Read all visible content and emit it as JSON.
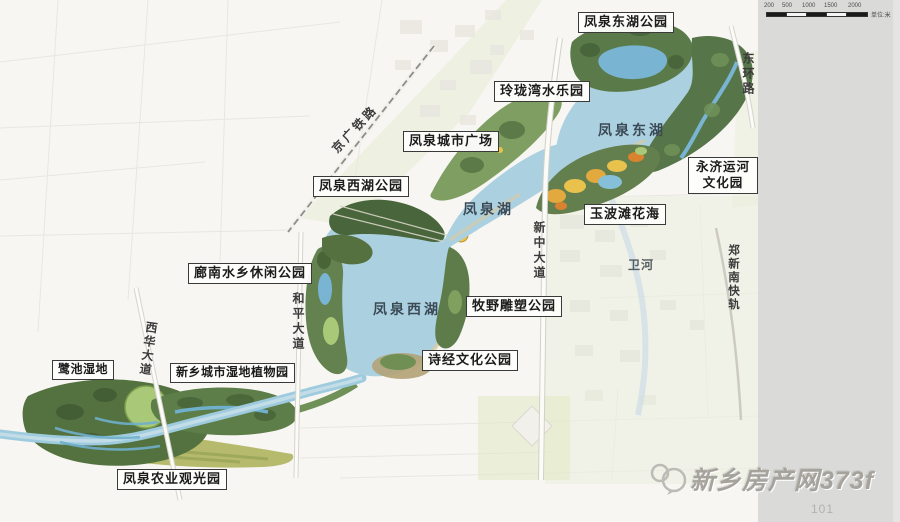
{
  "labels": {
    "parks_boxed": [
      {
        "text": "凤泉东湖公园"
      },
      {
        "text": "玲珑湾水乐园"
      },
      {
        "text": "凤泉城市广场"
      },
      {
        "text": "凤泉西湖公园"
      },
      {
        "line1": "永济运河",
        "line2": "文化园"
      },
      {
        "text": "玉波滩花海"
      },
      {
        "text": "廊南水乡休闲公园"
      },
      {
        "text": "牧野雕塑公园"
      },
      {
        "text": "诗经文化公园"
      },
      {
        "text": "鹭池湿地"
      },
      {
        "text": "新乡城市湿地植物园"
      },
      {
        "text": "凤泉农业观光园"
      }
    ],
    "water": [
      {
        "text": "凤泉东湖"
      },
      {
        "text": "凤泉湖"
      },
      {
        "text": "凤泉西湖"
      },
      {
        "text": "卫河"
      }
    ],
    "roads": [
      {
        "text": "京广铁路"
      },
      {
        "text": "东环路"
      },
      {
        "text": "新中大道"
      },
      {
        "text": "郑新南快轨"
      },
      {
        "text": "和平大道"
      },
      {
        "text": "西华大道"
      }
    ]
  },
  "scale_bar": {
    "ticks": [
      "200",
      "500",
      "1000",
      "1500",
      "2000"
    ],
    "unit": "单位:米"
  },
  "watermark": {
    "site": "新乡房产网373f"
  },
  "page_number": "101",
  "colors": {
    "lake_water": "#abd0e0",
    "pond_water": "#79b4d2",
    "park_dark_green": "#4d6a3e",
    "park_mid_green": "#6f9057",
    "park_light_green": "#a9c878",
    "flower_yellow": "#e9c24e",
    "flower_orange": "#d9822f",
    "sidebar_gray": "#dadad8",
    "map_background": "#f7f6f3"
  }
}
